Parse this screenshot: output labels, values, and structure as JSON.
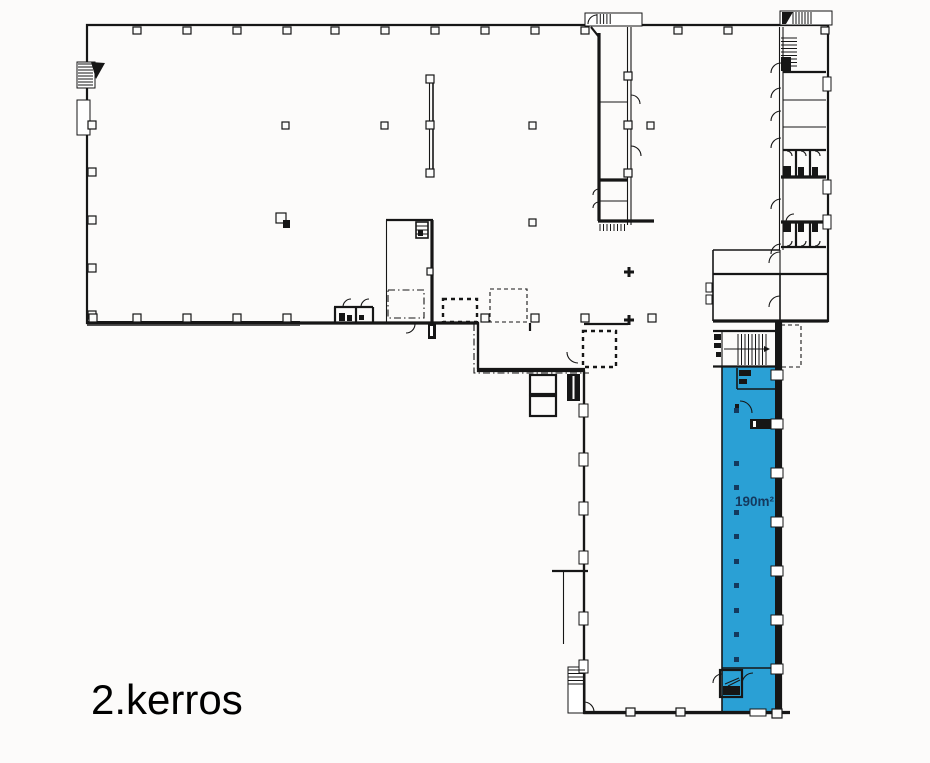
{
  "labels": {
    "floor": "2.kerros",
    "unit_area": "190m²"
  },
  "colors": {
    "background": "#fcfbfa",
    "floor_fill": "#f0efed",
    "highlight_fill": "#2aa0d5",
    "wall": "#161616",
    "area_label_text": "#14395e",
    "floor_label_text": "#000000"
  }
}
